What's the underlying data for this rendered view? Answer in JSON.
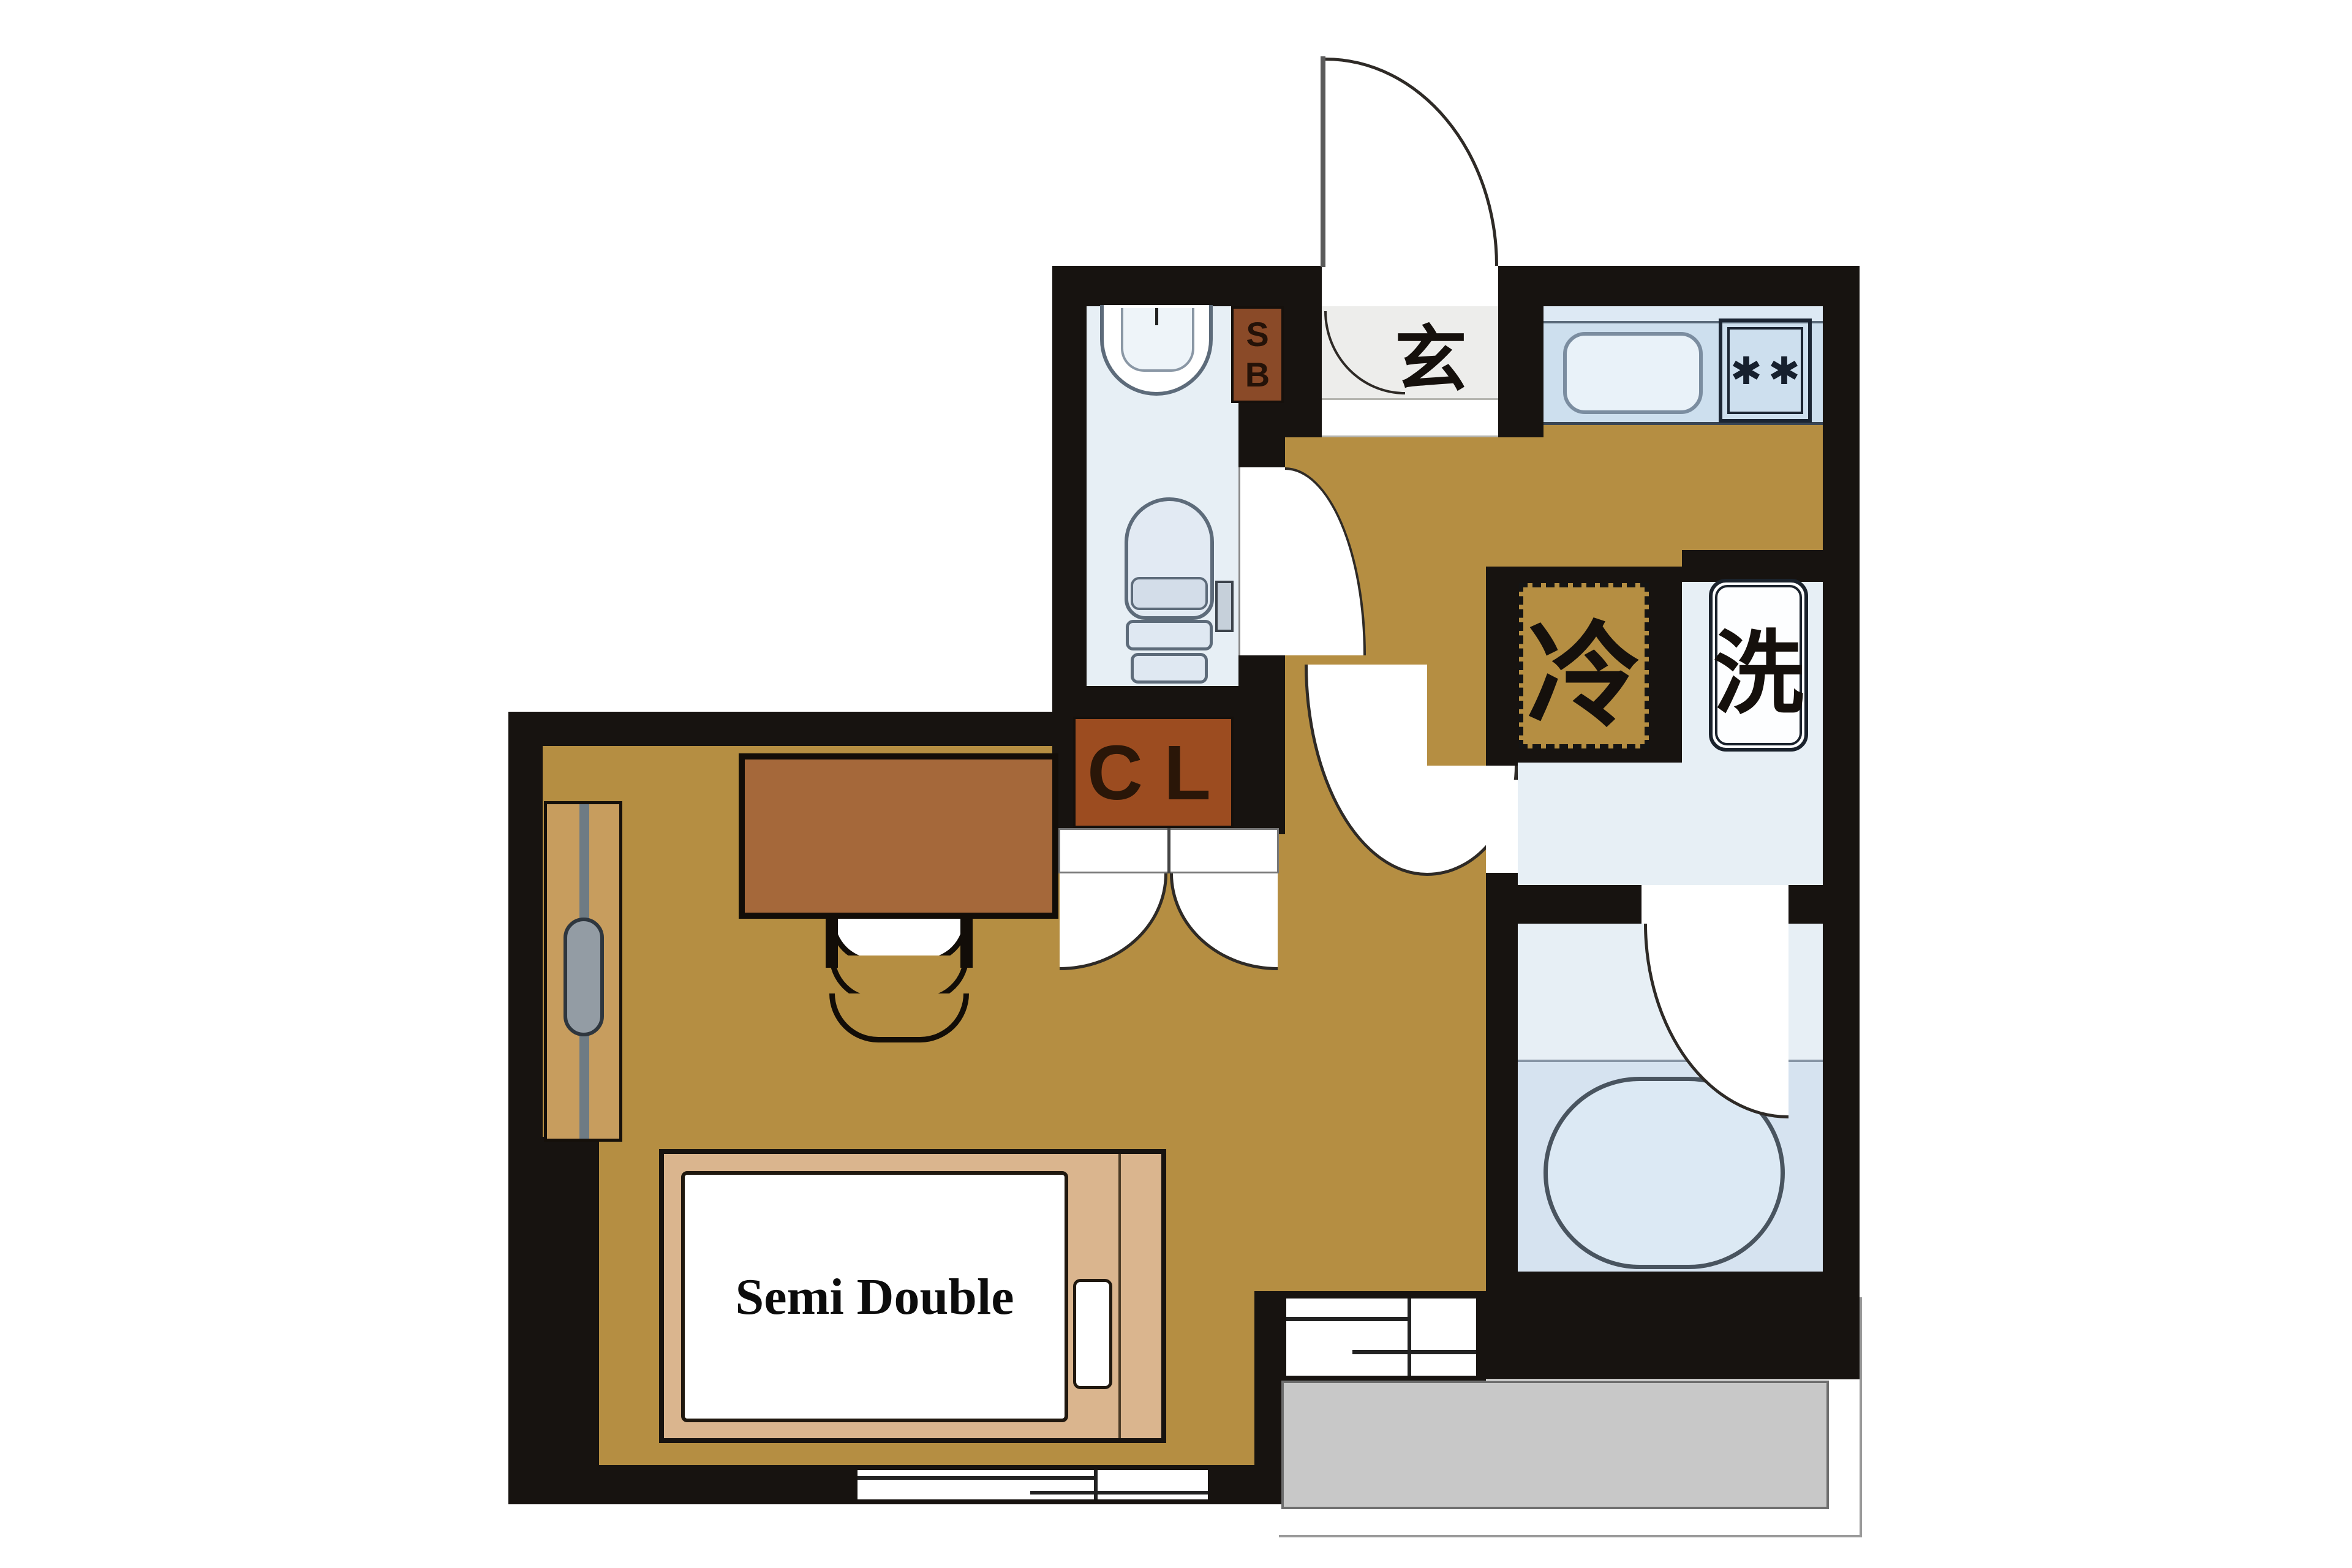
{
  "page": {
    "title": "Japanese apartment floor plan (1R, semi double bed)",
    "background_color": "#ffffff"
  },
  "labels": {
    "entrance_kanji": "玄",
    "fridge_kanji": "冷",
    "washer_kanji": "洗",
    "closet": "CL",
    "shoebox_s": "S",
    "shoebox_b": "B",
    "bed_size": "Semi Double",
    "burner": "✱"
  },
  "colors": {
    "wall": "#171310",
    "flooring": "#b58e42",
    "wet_area_floor": "#e7eff5",
    "kitchen_counter": "#cddfee",
    "bath_zone": "#d6e3f0",
    "closet_box": "#9c4c20",
    "shoebox_box": "#8a4a28",
    "bed_frame": "#dab58e",
    "desk": "#a5683a",
    "balcony": "#c8c8c8",
    "entrance_tile": "#ededeb"
  }
}
